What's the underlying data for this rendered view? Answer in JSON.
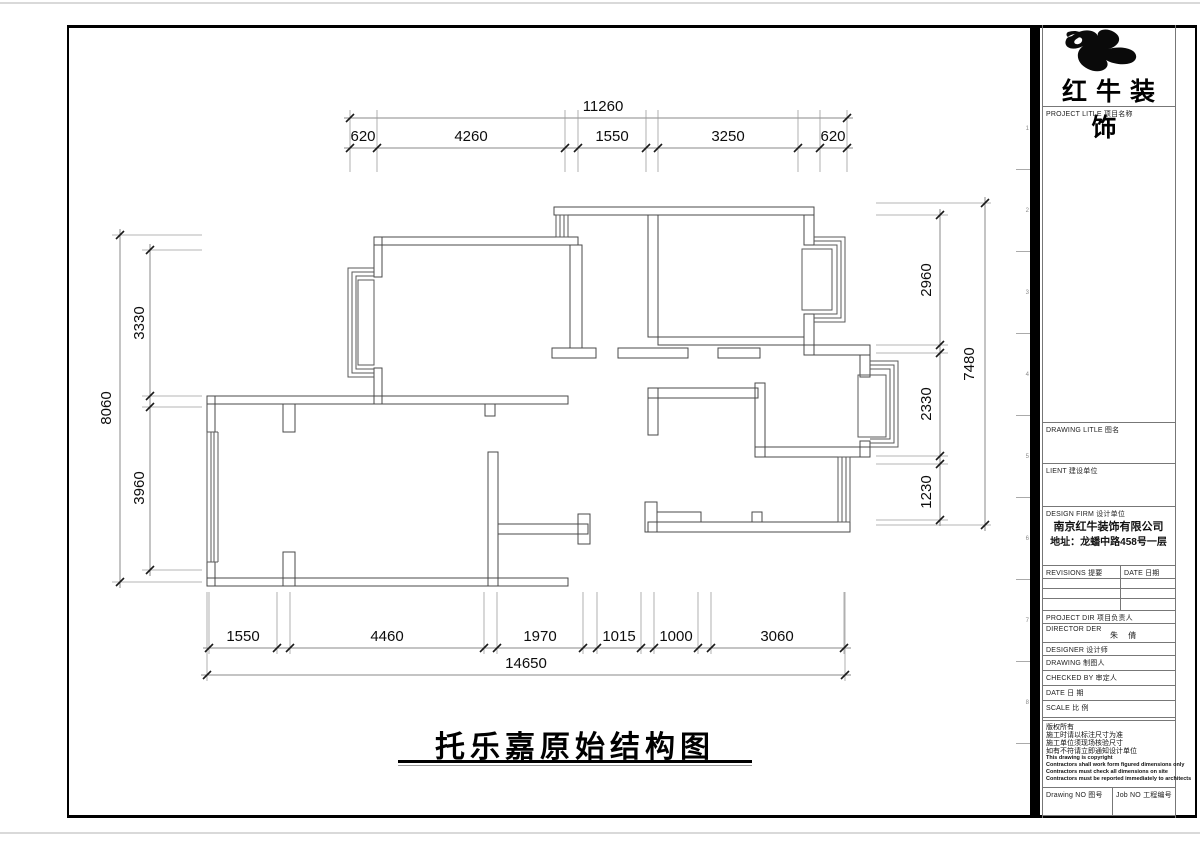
{
  "brand": {
    "name": "红牛装饰"
  },
  "plan": {
    "title": "托乐嘉原始结构图",
    "dims": {
      "top_total": "11260",
      "top_segments": [
        "620",
        "4260",
        "1550",
        "3250",
        "620"
      ],
      "bottom_total": "14650",
      "bottom_segments": [
        "1550",
        "4460",
        "1970",
        "1015",
        "1000",
        "3060"
      ],
      "left_total": "8060",
      "left_segments": [
        "3330",
        "3960"
      ],
      "right_total": "7480",
      "right_segments": [
        "2960",
        "2330",
        "1230"
      ]
    }
  },
  "title_block": {
    "project_title_label": "PROJECT LITLE  项目名称",
    "drawing_title_label": "DRAWING LITLE  图名",
    "client_label": "LIENT  建设单位",
    "design_firm_label": "DESIGN FIRM  设计单位",
    "firm_name": "南京红牛装饰有限公司",
    "firm_address": "地址：龙蟠中路458号一层",
    "revisions_label": "REVISIONS  提要",
    "revisions_date_label": "DATE  日期",
    "project_dir_label": "PROJECT DIR  项目负责人",
    "director_label": "DIRECTOR DER",
    "director_name": "朱 倩",
    "designer_label": "DESIGNER  设计师",
    "drawing_by_label": "DRAWING  制图人",
    "checked_by_label": "CHECKED BY  审定人",
    "date_label": "DATE  日 期",
    "scale_label": "SCALE  比 例",
    "copyright_lines": [
      "版权所有",
      "施工时请以标注尺寸为准",
      "施工单位须现场核验尺寸",
      "如有不符请立即通知设计单位",
      "This drawing is copyright",
      "Contractors shall work form figured dimensions only",
      "Contractors must check all dimensions on site",
      "Contractors must be reported immediately to architects"
    ],
    "drawing_no_label": "Drawing NO  图号",
    "job_no_label": "Job NO  工程编号"
  },
  "ruler_marks": [
    "1",
    "2",
    "3",
    "4",
    "5",
    "6",
    "7",
    "8"
  ]
}
